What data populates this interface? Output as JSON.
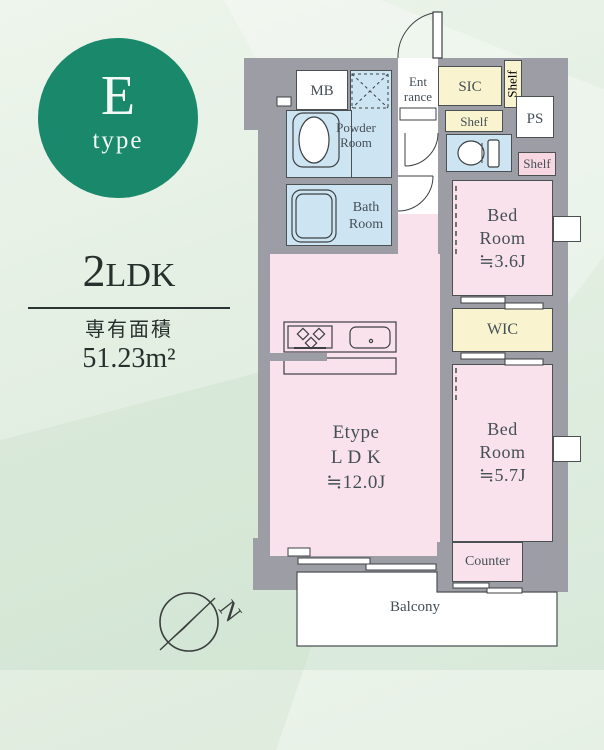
{
  "colors": {
    "background_green": "#e3efe2",
    "badge_teal": "#19886b",
    "wall_gray": "#9d9da5",
    "room_pink": "#f9e2eb",
    "room_blue": "#cde4f2",
    "room_yellow": "#f9f3cf",
    "shelf_pink": "#f7d7e2",
    "text_dark": "#26312e",
    "label_gray": "#454f56"
  },
  "badge": {
    "letter": "E",
    "sub": "type"
  },
  "info": {
    "layout_number": "2",
    "layout_type": "LDK",
    "area_label": "専有面積",
    "area_value": "51.23m²"
  },
  "plan": {
    "mb": "MB",
    "entrance_l1": "Ent",
    "entrance_l2": "rance",
    "sic": "SIC",
    "shelf": "Shelf",
    "ps": "PS",
    "powder_l1": "Powder",
    "powder_l2": "Room",
    "bath_l1": "Bath",
    "bath_l2": "Room",
    "bed3_l1": "Bed",
    "bed3_l2": "Room",
    "bed3_size": "≒3.6J",
    "wic": "WIC",
    "bed5_l1": "Bed",
    "bed5_l2": "Room",
    "bed5_size": "≒5.7J",
    "ldk_l1": "Etype",
    "ldk_l2": "L D K",
    "ldk_size": "≒12.0J",
    "counter": "Counter",
    "balcony": "Balcony"
  },
  "compass": {
    "north": "N"
  }
}
